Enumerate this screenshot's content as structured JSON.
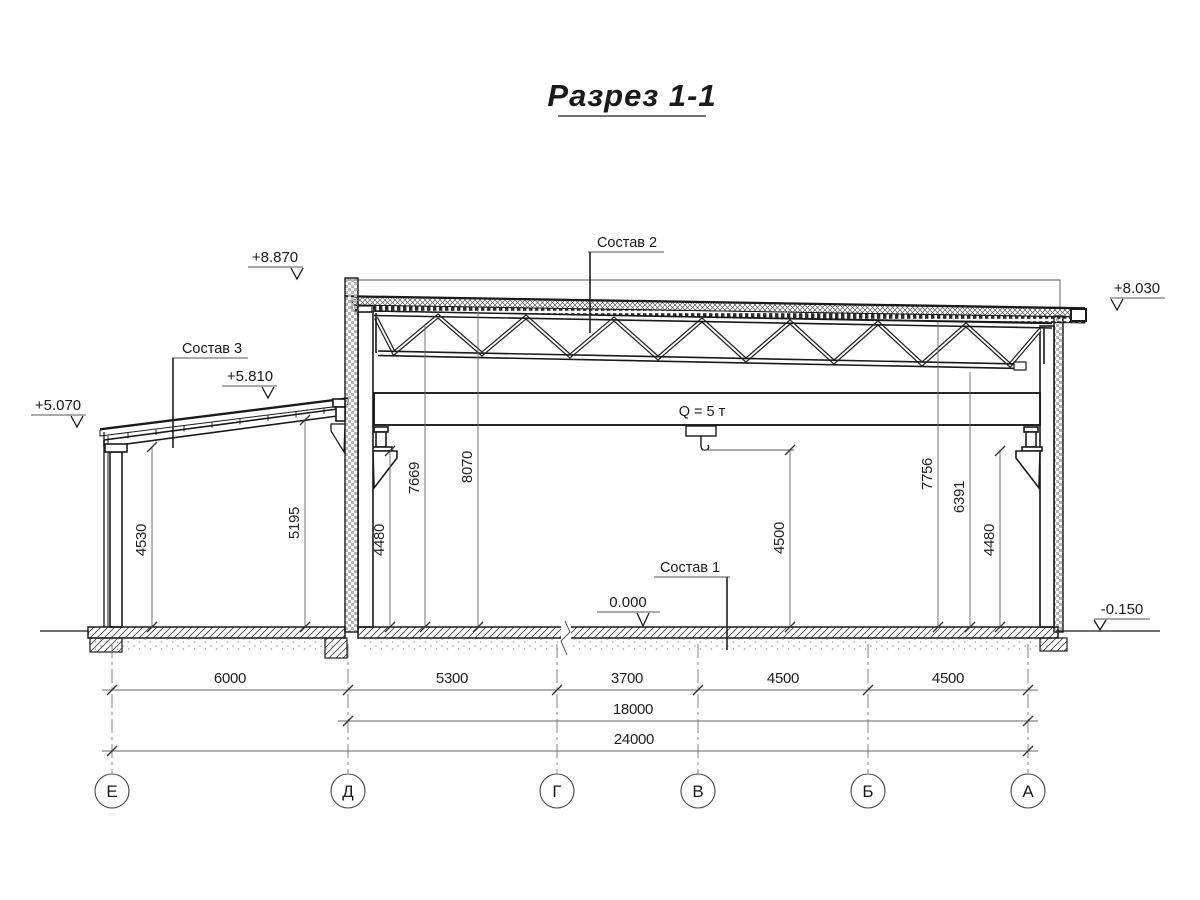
{
  "title": "Разрез 1-1",
  "marks": {
    "m8870": "+8.870",
    "m8030": "+8.030",
    "m5810": "+5.810",
    "m5070": "+5.070",
    "m0000": "0.000",
    "m0150": "-0.150"
  },
  "labels": {
    "sostav1": "Состав 1",
    "sostav2": "Состав 2",
    "sostav3": "Состав 3",
    "crane_capacity": "Q = 5 т"
  },
  "vertical_dims": {
    "annex_left": "4530",
    "annex_right": "5195",
    "main_left_crane": "4480",
    "main_left_truss": "7669",
    "main_left_roof": "8070",
    "hook_height": "4500",
    "main_right_roof": "7756",
    "main_right_truss": "6391",
    "main_right_crane": "4480"
  },
  "horizontal_dims": {
    "span_e_d": "6000",
    "span_d_g": "5300",
    "span_g_v": "3700",
    "span_v_b": "4500",
    "span_b_a": "4500",
    "total_d_a": "18000",
    "total_e_a": "24000"
  },
  "axes": {
    "e": "Е",
    "d": "Д",
    "g": "Г",
    "v": "В",
    "b": "Б",
    "a": "А"
  }
}
